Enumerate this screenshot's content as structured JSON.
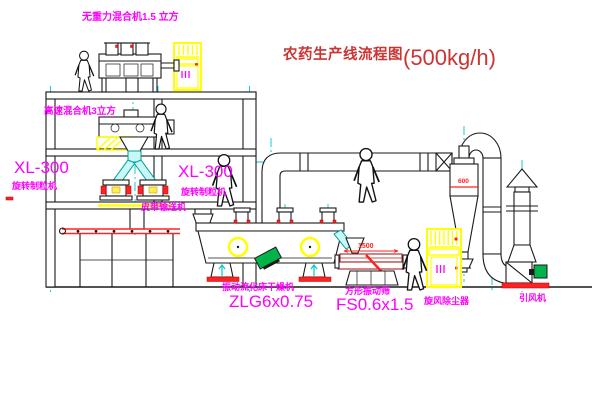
{
  "title": {
    "text": "农药生产线流程图",
    "capacity": "(500kg/h)"
  },
  "labels": {
    "mixer1": "无重力混合机1.5 立方",
    "mixer2": "高速混合机3立方",
    "granulator_left_model": "XL-300",
    "granulator_left_name": "旋转制粒机",
    "granulator_mid_model": "XL-300",
    "granulator_mid_name": "旋转制粒机",
    "belt_conveyor": "皮带输送机",
    "dryer_name": "振动流化床干燥机",
    "dryer_model": "ZLG6x0.75",
    "sieve_name": "方形振动筛",
    "sieve_model": "FS0.6x1.5",
    "dust_collector": "旋风除尘器",
    "fan": "引风机"
  },
  "dimensions": {
    "sieve_length": "1500",
    "cyclone_level": "600"
  },
  "colors": {
    "label_magenta": "#ff00ff",
    "title_red": "#cc3333",
    "line_black": "#1a1a1a",
    "centerline_cyan": "#00c8c8",
    "cabinet_yellow": "#ffff00",
    "accent_red": "#ff2222",
    "motor_green": "#00b44b"
  }
}
